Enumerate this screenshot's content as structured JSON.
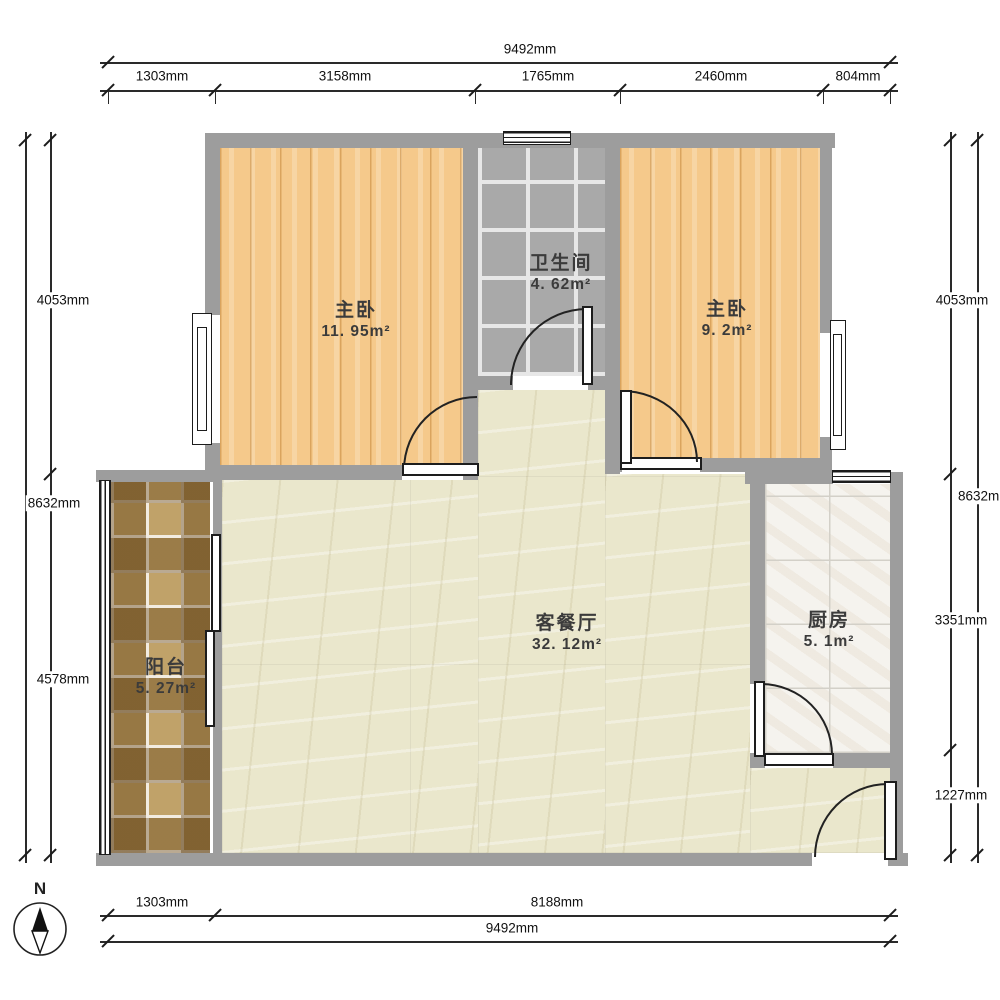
{
  "compass": {
    "north_label": "N"
  },
  "rooms": {
    "bedroom_left": {
      "name": "主卧",
      "area": "11. 95m²"
    },
    "bathroom": {
      "name": "卫生间",
      "area": "4. 62m²"
    },
    "bedroom_right": {
      "name": "主卧",
      "area": "9. 2m²"
    },
    "living_dining": {
      "name": "客餐厅",
      "area": "32. 12m²"
    },
    "kitchen": {
      "name": "厨房",
      "area": "5. 1m²"
    },
    "balcony": {
      "name": "阳台",
      "area": "5. 27m²"
    }
  },
  "dimensions": {
    "top_total": "9492mm",
    "top_segments": [
      "1303mm",
      "3158mm",
      "1765mm",
      "2460mm",
      "804mm"
    ],
    "left_total": "8632mm",
    "left_segments": [
      "4053mm",
      "4578mm"
    ],
    "right_total": "8632mm",
    "right_segments": [
      "4053mm",
      "3351mm",
      "1227mm"
    ],
    "bottom_segments": [
      "1303mm",
      "8188mm"
    ],
    "bottom_total": "9492mm"
  },
  "colors": {
    "wall": "#9d9d9d",
    "wood_floor": "#f5c98b",
    "living_floor": "#eae7cc",
    "bath_tile": "#a9a9a9",
    "kitchen_tile": "#f5f3ee",
    "balcony_tile": "#c0a269",
    "line": "#1c1c1c"
  }
}
